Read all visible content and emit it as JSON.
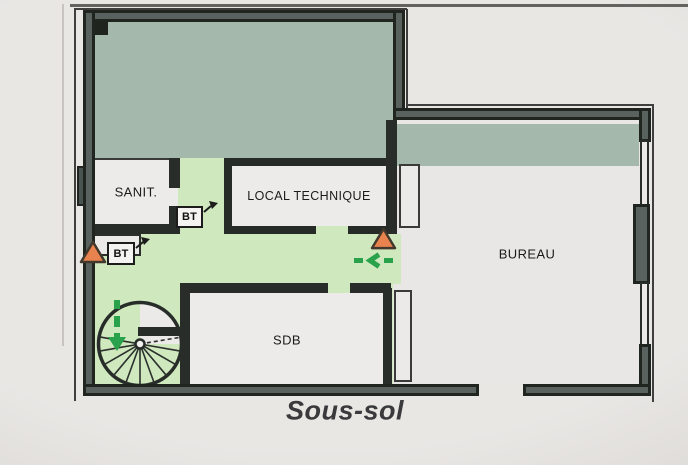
{
  "plan": {
    "floor_title": "Sous-sol",
    "rooms": {
      "sanit": "SANIT.",
      "local_technique": "LOCAL TECHNIQUE",
      "bureau": "BUREAU",
      "sdb": "SDB"
    },
    "markers": {
      "bt1": "BT",
      "bt2": "BT"
    },
    "icons": {
      "alarm_triangle": "orange-warning-triangle",
      "manual_call_point": "bt-box-with-arrow",
      "evacuation_route": "green-dashed-arrow",
      "staircase": "spiral-stair"
    },
    "colors": {
      "wall_dark": "#20251f",
      "wall_core": "#59625e",
      "zone_upper_sage": "#a5b8ac",
      "zone_corridor_green": "#cfe8be",
      "room_fill": "#edebe9",
      "alarm_orange": "#e8824e",
      "route_green": "#2aa24b",
      "background": "#e9e7e4",
      "text": "#1b1b1b"
    }
  }
}
